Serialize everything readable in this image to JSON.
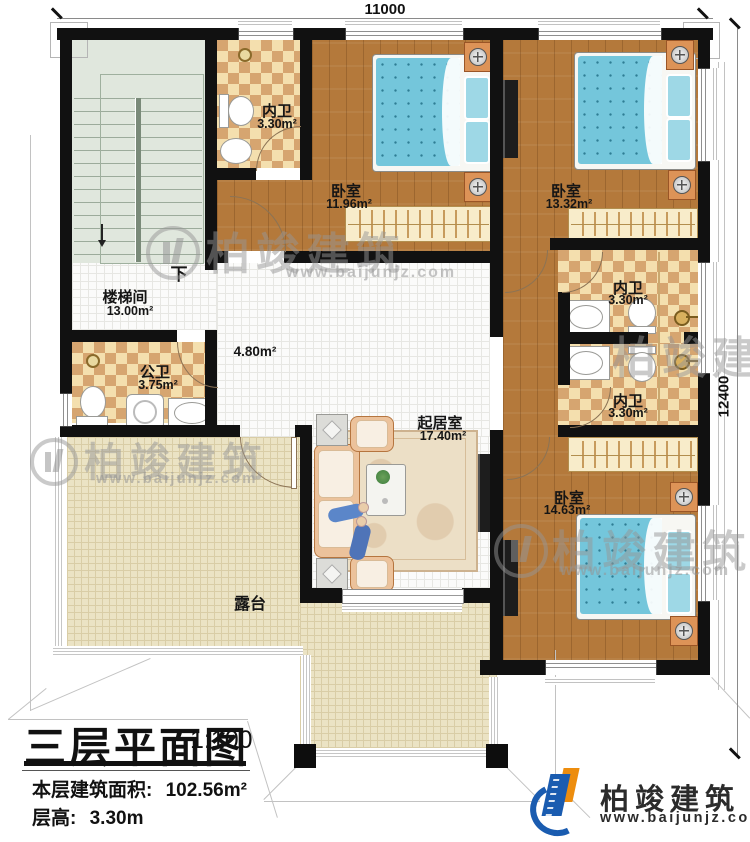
{
  "dimensions": {
    "top": "11000",
    "right": "12400"
  },
  "rooms": {
    "neiwei1": {
      "name": "内卫",
      "area": "3.30m²"
    },
    "bedroom1": {
      "name": "卧室",
      "area": "11.96m²"
    },
    "bedroom2": {
      "name": "卧室",
      "area": "13.32m²"
    },
    "stairwell": {
      "name": "楼梯间",
      "area": "13.00m²",
      "down": "下"
    },
    "hall": {
      "area": "4.80m²"
    },
    "gongwei": {
      "name": "公卫",
      "area": "3.75m²"
    },
    "neiwei2": {
      "name": "内卫",
      "area": "3.30m²"
    },
    "neiwei3": {
      "name": "内卫",
      "area": "3.30m²"
    },
    "living": {
      "name": "起居室",
      "area": "17.40m²"
    },
    "bedroom3": {
      "name": "卧室",
      "area": "14.63m²"
    },
    "terrace": {
      "name": "露台"
    }
  },
  "title": {
    "name": "三层平面图",
    "scale": "1:100",
    "area_label": "本层建筑面积:",
    "area_value": "102.56m²",
    "height_label": "层高:",
    "height_value": "3.30m"
  },
  "brand": {
    "name": "柏竣建筑",
    "url": "www.baijunjz.com"
  },
  "watermark": {
    "name": "柏竣建筑",
    "url": "www.baijunjz.com"
  },
  "colors": {
    "wall": "#111111",
    "wood": "#b4793b",
    "check_light": "#f4dfae",
    "check_dark": "#d6a570",
    "stair": "#e0e7dd",
    "terrace": "#ebe3c4",
    "bed_blue": "#74c6db",
    "brand_blue": "#1a5cb0",
    "brand_orange": "#ed8d0e"
  }
}
